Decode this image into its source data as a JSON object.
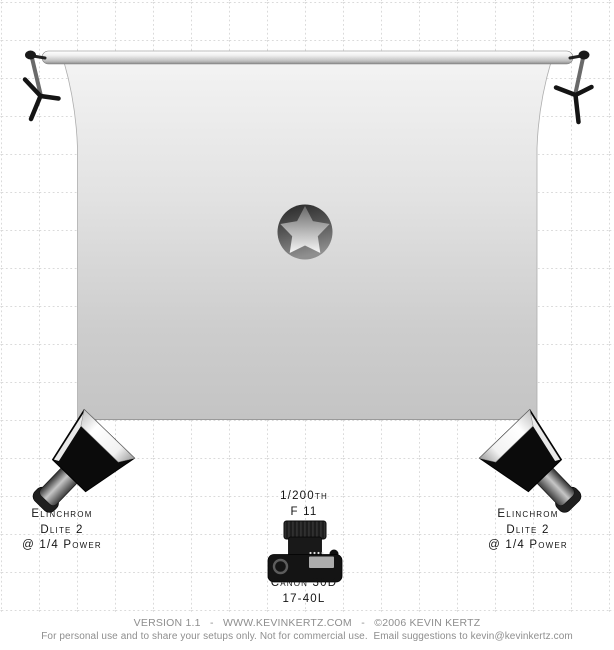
{
  "diagram_title": "studio lighting setup diagram",
  "lights": {
    "left": {
      "lines": [
        "Elinchrom",
        "Dlite 2",
        "@ 1/4 Power"
      ]
    },
    "right": {
      "lines": [
        "Elinchrom",
        "Dlite 2",
        "@ 1/4 Power"
      ]
    }
  },
  "camera": {
    "exposure": [
      "1/200th",
      "F 11"
    ],
    "model": [
      "Canon 30D",
      "17-40L"
    ]
  },
  "footer": {
    "line1": "VERSION 1.1   -   WWW.KEVINKERTZ.COM   -   ©2006 KEVIN KERTZ",
    "line2": "For personal use and to share your setups only. Not for commercial use.  Email suggestions to kevin@kevinkertz.com"
  },
  "colors": {
    "grid_line": "#b4b4b4",
    "label_text": "#141414",
    "footer_text": "#8e8e8e",
    "backdrop_top": "#f3f3f3",
    "backdrop_bottom": "#c4c4c4",
    "softbox_body": "#0b0b0b",
    "softbox_diffuser": "#ffffff"
  }
}
